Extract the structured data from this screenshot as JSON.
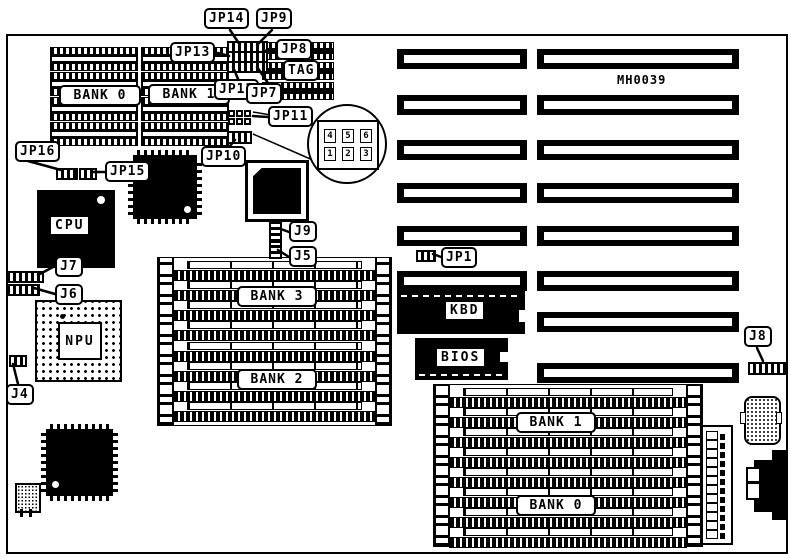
{
  "colors": {
    "ink": "#000000",
    "background": "#ffffff"
  },
  "board": {
    "id_text": "MH0039"
  },
  "chips": {
    "cpu": "CPU",
    "npu": "NPU",
    "kbd": "KBD",
    "bios": "BIOS",
    "tag": "TAG"
  },
  "memory": {
    "dip_bank0": "BANK 0",
    "dip_bank1": "BANK 1",
    "simm_bank3": "BANK 3",
    "simm_bank2": "BANK 2",
    "simm_bank1": "BANK 1",
    "simm_bank0": "BANK 0"
  },
  "jumpers": {
    "jp1": "JP1",
    "jp7": "JP7",
    "jp8": "JP8",
    "jp9": "JP9",
    "jp10": "JP10",
    "jp11": "JP11",
    "jp12": "JP12",
    "jp13": "JP13",
    "jp14": "JP14",
    "jp15": "JP15",
    "jp16": "JP16",
    "j4": "J4",
    "j5": "J5",
    "j6": "J6",
    "j7": "J7",
    "j8": "J8",
    "j9": "J9"
  },
  "magnifier": {
    "pin4": "4",
    "pin5": "5",
    "pin6": "6",
    "pin1": "1",
    "pin2": "2",
    "pin3": "3"
  }
}
